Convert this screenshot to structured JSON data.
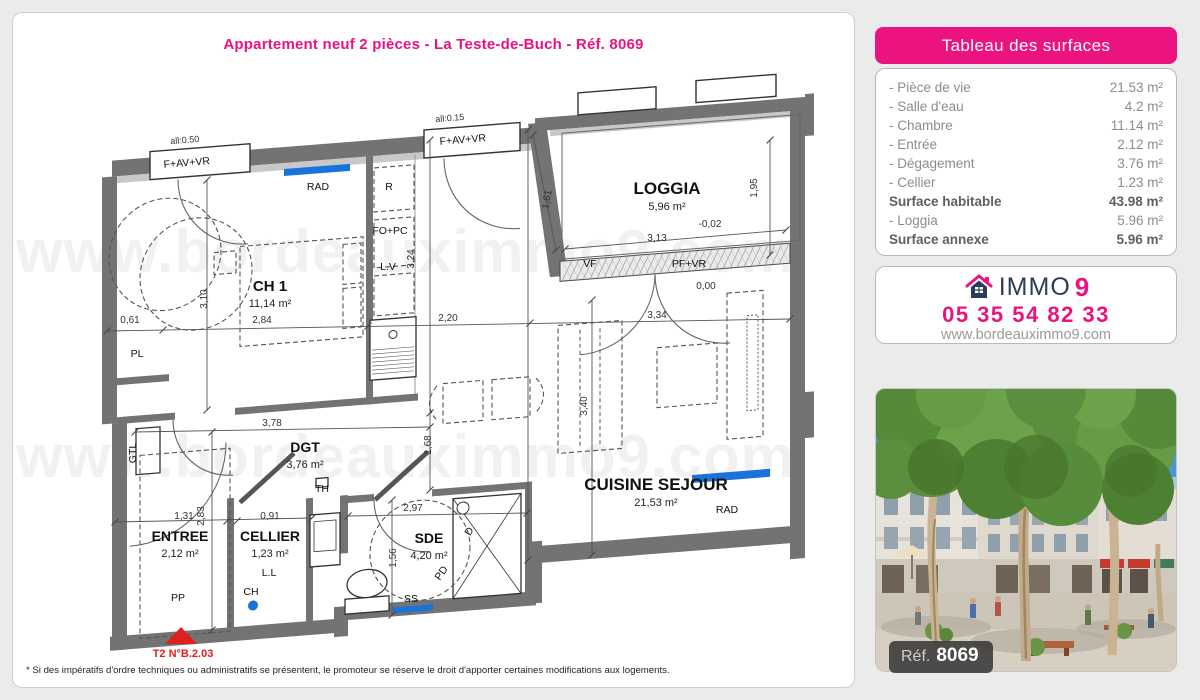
{
  "page": {
    "title": "Appartement neuf 2 pièces - La Teste-de-Buch - Réf. 8069",
    "disclaimer": "* Si des impératifs d'ordre techniques ou administratifs se présentent, le promoteur se réserve le droit d'apporter certaines modifications aux logements."
  },
  "surface_table": {
    "header": "Tableau des surfaces",
    "rows": [
      {
        "label": "- Pièce de vie",
        "value": "21.53 m²",
        "strong": false
      },
      {
        "label": "- Salle d'eau",
        "value": "4.2 m²",
        "strong": false
      },
      {
        "label": "- Chambre",
        "value": "11.14 m²",
        "strong": false
      },
      {
        "label": "- Entrée",
        "value": "2.12 m²",
        "strong": false
      },
      {
        "label": "- Dégagement",
        "value": "3.76 m²",
        "strong": false
      },
      {
        "label": "- Cellier",
        "value": "1.23 m²",
        "strong": false
      },
      {
        "label": "Surface habitable",
        "value": "43.98 m²",
        "strong": true
      },
      {
        "label": "- Loggia",
        "value": "5.96 m²",
        "strong": false
      },
      {
        "label": "Surface annexe",
        "value": "5.96 m²",
        "strong": true
      }
    ]
  },
  "agency": {
    "brand_immo": "IMMO",
    "brand_9": "9",
    "phone": "05 35 54 82 33",
    "website": "www.bordeauximmo9.com"
  },
  "photo": {
    "ref_label": "Réf.",
    "ref_value": "8069",
    "description": "street scene with plane trees and new residential buildings"
  },
  "plan": {
    "watermark": {
      "text": "www.bordeauximmo9.com",
      "rows": [
        272,
        477
      ]
    },
    "rooms": [
      {
        "name": "CH 1",
        "area": "11,14 m²",
        "x": 270,
        "y": 291,
        "fs": 15
      },
      {
        "name": "LOGGIA",
        "area": "5,96 m²",
        "x": 667,
        "y": 194,
        "fs": 17
      },
      {
        "name": "CUISINE SEJOUR",
        "area": "21,53 m²",
        "x": 656,
        "y": 490,
        "fs": 17
      },
      {
        "name": "DGT",
        "area": "3,76 m²",
        "x": 305,
        "y": 452,
        "fs": 14
      },
      {
        "name": "ENTREE",
        "area": "2,12 m²",
        "x": 180,
        "y": 541,
        "fs": 14
      },
      {
        "name": "CELLIER",
        "area": "1,23 m²",
        "x": 270,
        "y": 541,
        "fs": 14
      },
      {
        "name": "SDE",
        "area": "4,20 m²",
        "x": 429,
        "y": 543,
        "fs": 14
      }
    ],
    "equipment": [
      {
        "t": "RAD",
        "x": 318,
        "y": 190
      },
      {
        "t": "R",
        "x": 389,
        "y": 190
      },
      {
        "t": "FO+PC",
        "x": 390,
        "y": 234
      },
      {
        "t": "L.V",
        "x": 388,
        "y": 270
      },
      {
        "t": "RAD",
        "x": 727,
        "y": 513
      },
      {
        "t": "PL",
        "x": 137,
        "y": 357
      },
      {
        "t": "GTL",
        "x": 136,
        "y": 453,
        "r": -90
      },
      {
        "t": "TH",
        "x": 322,
        "y": 492
      },
      {
        "t": "L.L",
        "x": 269,
        "y": 576
      },
      {
        "t": "CH",
        "x": 251,
        "y": 595
      },
      {
        "t": "PP",
        "x": 178,
        "y": 601
      },
      {
        "t": "PD",
        "x": 444,
        "y": 575,
        "r": -55
      },
      {
        "t": "SS",
        "x": 411,
        "y": 602
      },
      {
        "t": "D",
        "x": 472,
        "y": 533,
        "r": -60
      },
      {
        "t": "VF",
        "x": 590,
        "y": 267
      },
      {
        "t": "PF+VR",
        "x": 689,
        "y": 267
      },
      {
        "t": "F+AV+VR",
        "x": 187,
        "y": 166,
        "r": -4.5
      },
      {
        "t": "F+AV+VR",
        "x": 463,
        "y": 143,
        "r": -4.5
      },
      {
        "t": "all:0.50",
        "x": 185,
        "y": 143,
        "r": -4.5,
        "small": true
      },
      {
        "t": "all:0.15",
        "x": 450,
        "y": 121,
        "r": -4.5,
        "small": true
      }
    ],
    "dimensions": [
      {
        "t": "0,61",
        "x": 130,
        "y": 323
      },
      {
        "t": "2,84",
        "x": 262,
        "y": 323
      },
      {
        "t": "2,20",
        "x": 448,
        "y": 321
      },
      {
        "t": "3,34",
        "x": 657,
        "y": 318
      },
      {
        "t": "3,10",
        "x": 207,
        "y": 299,
        "r": -90
      },
      {
        "t": "3,24",
        "x": 414,
        "y": 259,
        "r": -90
      },
      {
        "t": "1,95",
        "x": 757,
        "y": 188,
        "r": -90
      },
      {
        "t": "1,61",
        "x": 550,
        "y": 200,
        "r": -80
      },
      {
        "t": "3,13",
        "x": 657,
        "y": 241
      },
      {
        "t": "-0,02",
        "x": 710,
        "y": 227
      },
      {
        "t": "0,00",
        "x": 706,
        "y": 289
      },
      {
        "t": "3,78",
        "x": 272,
        "y": 426
      },
      {
        "t": "1,68",
        "x": 431,
        "y": 445,
        "r": -90
      },
      {
        "t": "3,40",
        "x": 587,
        "y": 406,
        "r": -90
      },
      {
        "t": "1,31",
        "x": 184,
        "y": 519
      },
      {
        "t": "0,91",
        "x": 270,
        "y": 519
      },
      {
        "t": "2,83",
        "x": 204,
        "y": 516,
        "r": -90
      },
      {
        "t": "2,97",
        "x": 413,
        "y": 511
      },
      {
        "t": "1,56",
        "x": 396,
        "y": 558,
        "r": -90
      }
    ],
    "marker": {
      "label": "T2 N°B.2.03",
      "x": 183,
      "y": 657
    }
  },
  "colors": {
    "accent_pink": "#ea1380",
    "navy": "#2b3d59",
    "radiator_blue": "#1a73d9",
    "marker_red": "#e02020"
  }
}
